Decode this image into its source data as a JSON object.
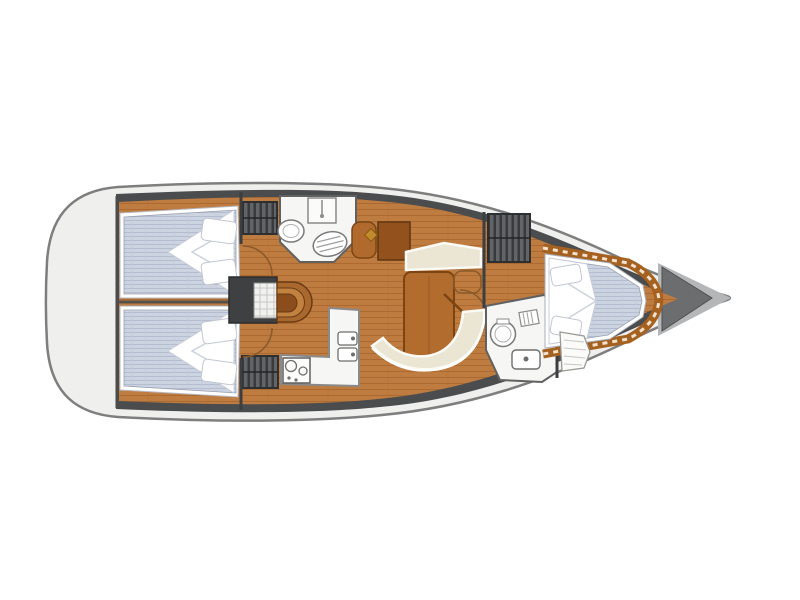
{
  "diagram": {
    "kind": "yacht-interior-floor-plan",
    "orientation": "bow-right",
    "visible_text": "none"
  },
  "colors": {
    "background": "#ffffff",
    "hull_fill": "#efefed",
    "hull_outline": "#7e7e7e",
    "interior_dark": "#4b4c4e",
    "locker_dark": "#5d5e61",
    "wood_floor": "#bf7c40",
    "wood_trim": "#a5611f",
    "table_wood": "#b26c2d",
    "table_edge": "#7d4413",
    "mattress_blue": "#cdd4e1",
    "bedding_white": "#ffffff",
    "settee_cream": "#eae6d3",
    "fixture_white": "#f6f6f4",
    "fixture_outline": "#6a6a6a",
    "bow_band_grey": "#b5b6b8",
    "bow_locker_grey": "#6c6d6f",
    "mast_accent": "#c08a2e"
  },
  "parts": [
    {
      "id": "hull",
      "role": "boat hull outline"
    },
    {
      "id": "stern-platform",
      "role": "aft swim/stern platform"
    },
    {
      "id": "aft-cabin-port",
      "role": "aft double berth with pillows and duvet"
    },
    {
      "id": "aft-cabin-starboard",
      "role": "aft double berth with pillows and duvet"
    },
    {
      "id": "aft-head",
      "role": "aft bathroom with toilet, sink, shower"
    },
    {
      "id": "wardrobe",
      "role": "hanging locker shown with hanger stripes"
    },
    {
      "id": "companionway-steps",
      "role": "entry steps over engine box"
    },
    {
      "id": "galley",
      "role": "L-shaped galley with stove and double sink"
    },
    {
      "id": "salon-table",
      "role": "saloon table"
    },
    {
      "id": "salon-settee",
      "role": "curved saloon settee and forward bench"
    },
    {
      "id": "nav-station",
      "role": "chart table and seat"
    },
    {
      "id": "mast-step",
      "role": "mast/compression post marker"
    },
    {
      "id": "forward-head",
      "role": "forward bathroom with toilet and sink"
    },
    {
      "id": "forward-cabin",
      "role": "V-berth forward cabin"
    },
    {
      "id": "anchor-locker",
      "role": "bow anchor locker"
    }
  ]
}
